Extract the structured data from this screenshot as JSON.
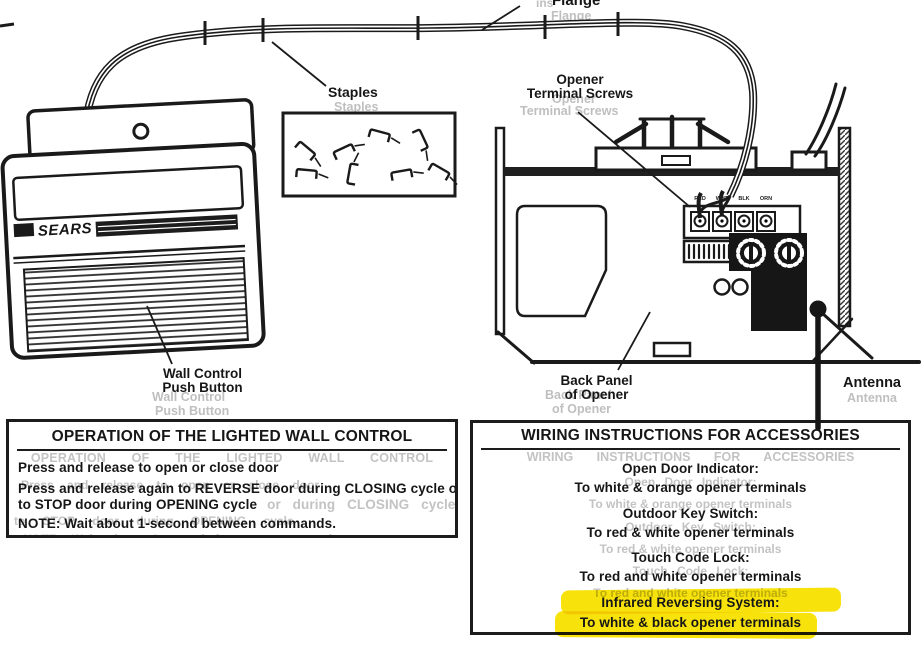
{
  "diagram": {
    "device_brand": "SEARS",
    "labels": {
      "flange": "Flange",
      "flange_ghost_prefix": "ins",
      "staples": "Staples",
      "opener_terminal_screws_line1": "Opener",
      "opener_terminal_screws_line2": "Terminal Screws",
      "wall_control_line1": "Wall Control",
      "wall_control_line2": "Push Button",
      "back_panel_line1": "Back Panel",
      "back_panel_line2": "of Opener",
      "antenna": "Antenna"
    },
    "terminal_labels": [
      "RED",
      "WHT",
      "BLK",
      "ORN"
    ]
  },
  "operation_box": {
    "title": "OPERATION OF THE LIGHTED WALL CONTROL",
    "line1": "Press and release to open or close door",
    "line2": "Press and release again to REVERSE door during CLOSING cycle or",
    "line3": "to STOP door during OPENING cycle",
    "line3_ghost_tail": "or during CLOSING cycle or",
    "note": "NOTE:  Wait about 1-second between commands."
  },
  "wiring_box": {
    "title": "WIRING INSTRUCTIONS FOR ACCESSORIES",
    "sections": [
      {
        "heading": "Open Door Indicator:",
        "detail": "To white & orange opener terminals"
      },
      {
        "heading": "Outdoor Key Switch:",
        "detail": "To red & white opener terminals"
      },
      {
        "heading": "Touch Code Lock:",
        "detail": "To red and white opener terminals"
      },
      {
        "heading": "Infrared Reversing System:",
        "detail": "To white & black opener terminals"
      }
    ]
  },
  "colors": {
    "ink": "#1a1a1a",
    "ghost": "#bfbfbf",
    "highlight": "#F8E20C"
  }
}
